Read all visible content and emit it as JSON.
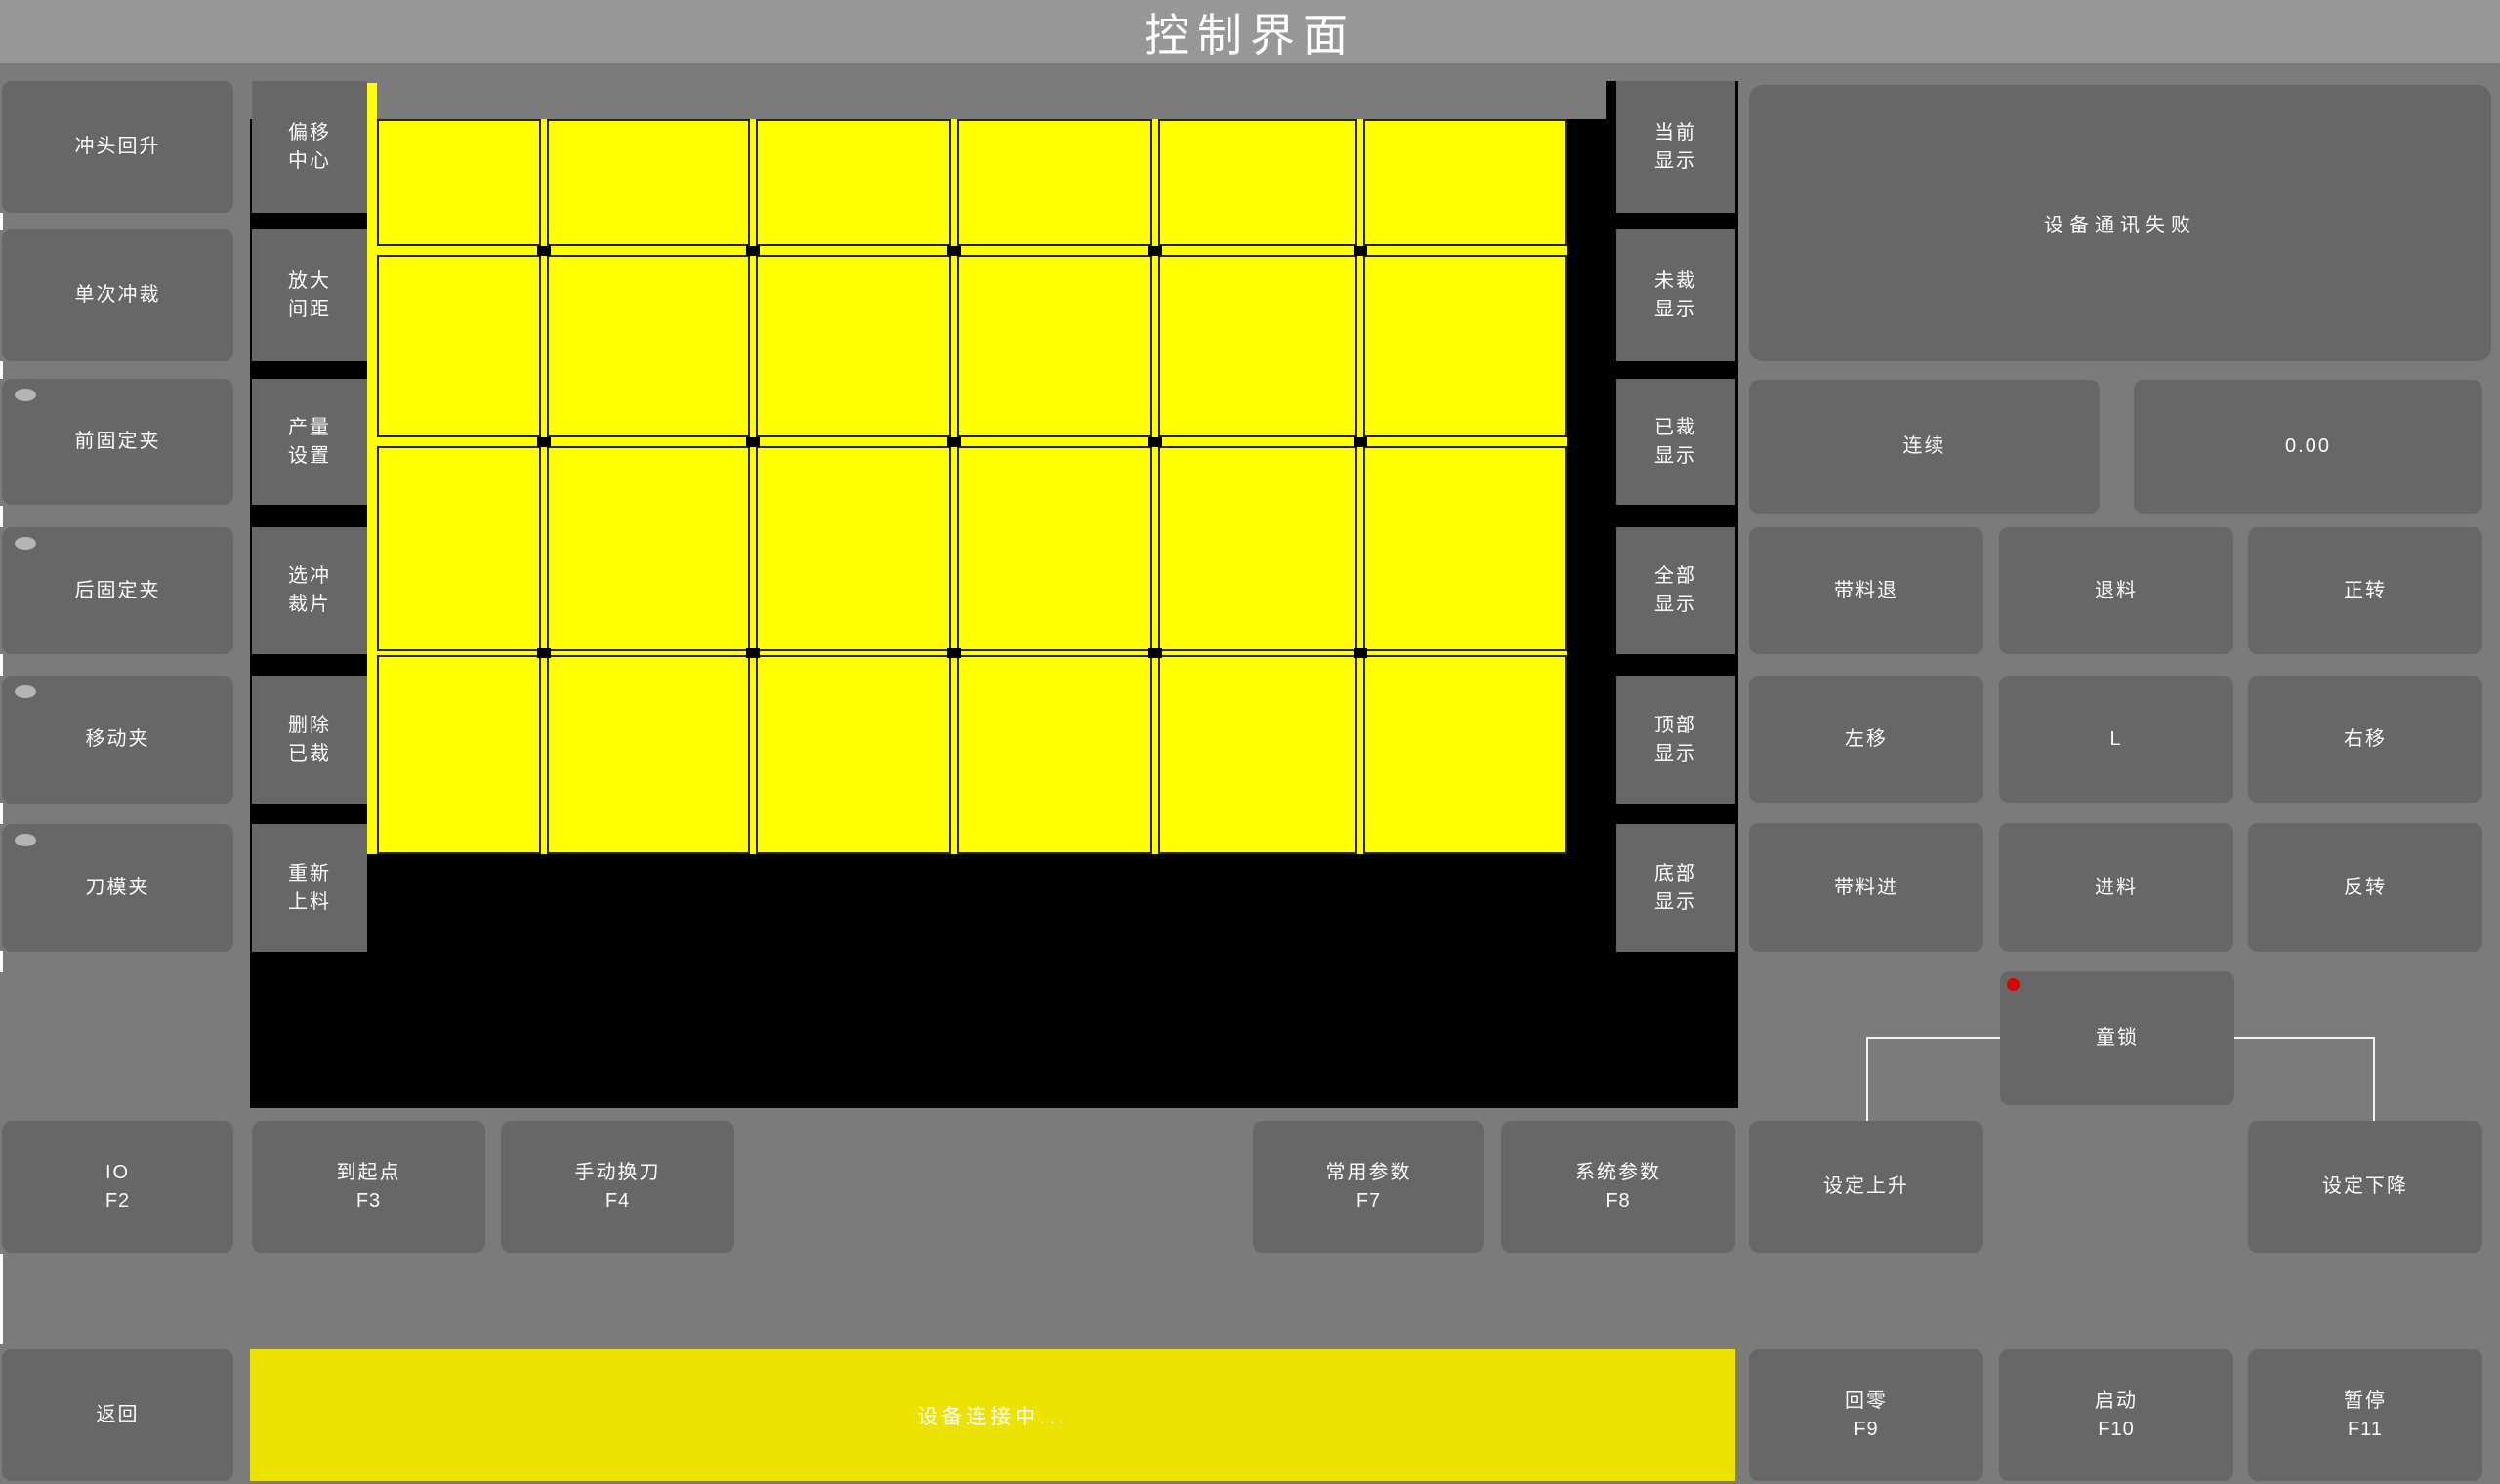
{
  "title": "控制界面",
  "left_buttons": [
    {
      "label": "冲头回升",
      "led": false
    },
    {
      "label": "单次冲裁",
      "led": false
    },
    {
      "label": "前固定夹",
      "led": true
    },
    {
      "label": "后固定夹",
      "led": true
    },
    {
      "label": "移动夹",
      "led": true
    },
    {
      "label": "刀模夹",
      "led": true
    }
  ],
  "tool_buttons": [
    {
      "lines": [
        "偏移",
        "中心"
      ]
    },
    {
      "lines": [
        "放大",
        "间距"
      ]
    },
    {
      "lines": [
        "产量",
        "设置"
      ]
    },
    {
      "lines": [
        "选冲",
        "裁片"
      ]
    },
    {
      "lines": [
        "删除",
        "已裁"
      ]
    },
    {
      "lines": [
        "重新",
        "上料"
      ]
    }
  ],
  "display_buttons": [
    {
      "lines": [
        "当前",
        "显示"
      ]
    },
    {
      "lines": [
        "未裁",
        "显示"
      ]
    },
    {
      "lines": [
        "已裁",
        "显示"
      ]
    },
    {
      "lines": [
        "全部",
        "显示"
      ]
    },
    {
      "lines": [
        "顶部",
        "显示"
      ]
    },
    {
      "lines": [
        "底部",
        "显示"
      ]
    }
  ],
  "right_panel": {
    "message": "设备通讯失败",
    "mode_button": "连续",
    "value_display": "0.00",
    "jog_rows": [
      [
        "带料退",
        "退料",
        "正转"
      ],
      [
        "左移",
        "L",
        "右移"
      ],
      [
        "带料进",
        "进料",
        "反转"
      ]
    ],
    "child_lock": "童锁"
  },
  "function_row": [
    {
      "label": "IO",
      "key": "F2"
    },
    {
      "label": "到起点",
      "key": "F3"
    },
    {
      "label": "手动换刀",
      "key": "F4"
    },
    {
      "label": "常用参数",
      "key": "F7"
    },
    {
      "label": "系统参数",
      "key": "F8"
    },
    {
      "label": "设定上升",
      "key": ""
    },
    {
      "label": "设定下降",
      "key": ""
    }
  ],
  "bottom_bar": {
    "back": "返回",
    "status": "设备连接中...",
    "buttons": [
      {
        "label": "回零",
        "key": "F9"
      },
      {
        "label": "启动",
        "key": "F10"
      },
      {
        "label": "暂停",
        "key": "F11"
      }
    ]
  },
  "material_grid": {
    "type": "table",
    "columns": 6,
    "rows": 4,
    "col_edges": [
      [
        0,
        168
      ],
      [
        174,
        382
      ],
      [
        388,
        588
      ],
      [
        594,
        794
      ],
      [
        800,
        1004
      ],
      [
        1010,
        1219
      ]
    ],
    "row_edges": [
      [
        0,
        130
      ],
      [
        139,
        326
      ],
      [
        335,
        545
      ],
      [
        549,
        753
      ]
    ],
    "piece_state": "uncut"
  },
  "colors": {
    "piece_yellow": "#ffff00",
    "status_yellow": "#ece300",
    "alarm_red": "#dd0000",
    "titlebar_gray": "#979797",
    "button_gray": "#676767",
    "background_gray": "#7b7b7b"
  }
}
